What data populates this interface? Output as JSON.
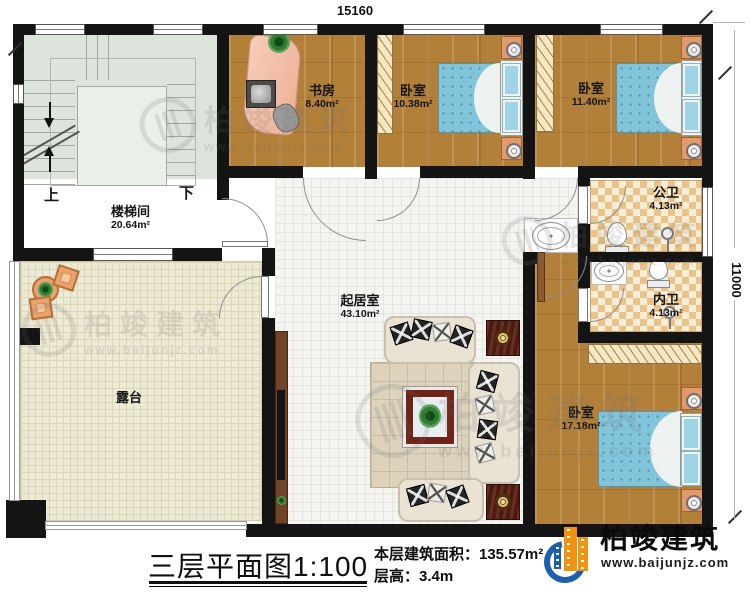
{
  "dimensions": {
    "width_mm": "15160",
    "height_mm": "11000"
  },
  "rooms": {
    "stairwell": {
      "name": "楼梯间",
      "area": "20.64m²"
    },
    "study": {
      "name": "书房",
      "area": "8.40m²"
    },
    "bedroom_small": {
      "name": "卧室",
      "area": "10.38m²"
    },
    "bedroom_mid": {
      "name": "卧室",
      "area": "11.40m²"
    },
    "public_bathroom": {
      "name": "公卫",
      "area": "4.13m²"
    },
    "private_bathroom": {
      "name": "内卫",
      "area": "4.13m²"
    },
    "bedroom_master": {
      "name": "卧室",
      "area": "17.18m²"
    },
    "living_room": {
      "name": "起居室",
      "area": "43.10m²"
    },
    "terrace": {
      "name": "露台"
    }
  },
  "stairs": {
    "up": "上",
    "down": "下"
  },
  "title_block": {
    "plan_title": "三层平面图",
    "scale": "1:100",
    "floor_area": "本层建筑面积：135.57m²",
    "floor_height": "层高：3.4m"
  },
  "brand": {
    "name": "柏竣建筑",
    "url": "www.baijunjz.com"
  }
}
